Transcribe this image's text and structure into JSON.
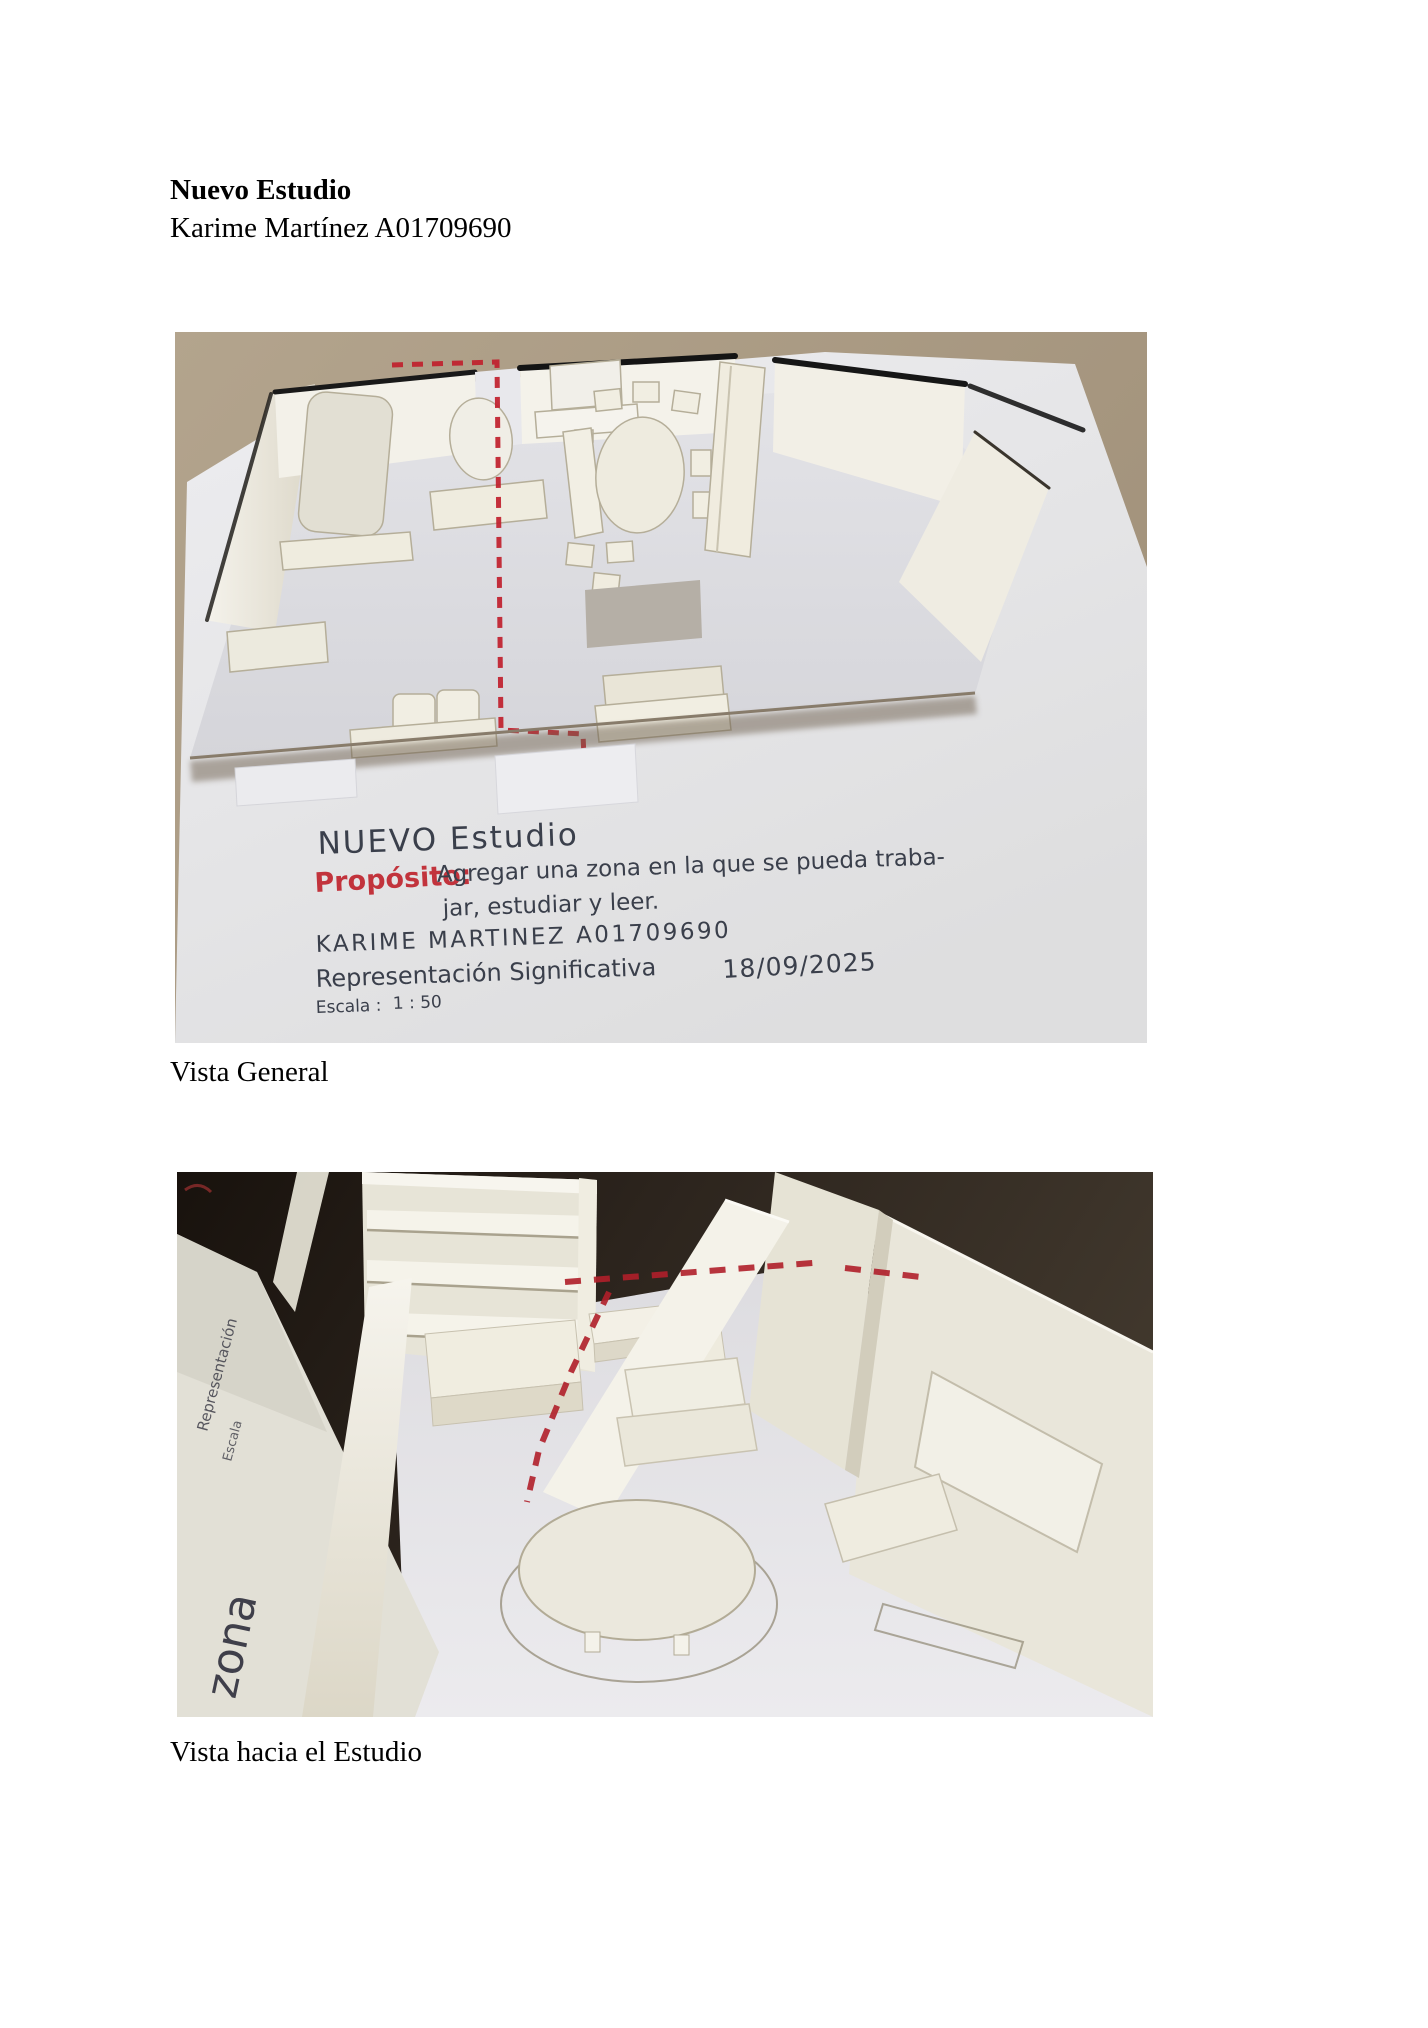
{
  "document": {
    "title": "Nuevo Estudio",
    "author": "Karime Martínez A01709690",
    "caption_photo1": "Vista General",
    "caption_photo2": "Vista hacia el Estudio"
  },
  "photo1": {
    "handwriting": {
      "title": "NUEVO Estudio",
      "purpose_label": "Propósito:",
      "purpose_line1": "Agregar una zona en la que se pueda traba-",
      "purpose_line2": "jar, estudiar y leer.",
      "author": "KARIME MARTINEZ  A01709690",
      "representation": "Representación Significativa",
      "date": "18/09/2025",
      "scale_label": "Escala :",
      "scale_value": "1 : 50"
    },
    "colors": {
      "table_surface": "#a99a83",
      "paper": "#e9e9ec",
      "cardboard": "#f1eee2",
      "marker_edge": "#1c1c1c",
      "zone_dashes": "#c0202c",
      "ink": "#3a3f4b",
      "ink_red": "#c2333c"
    }
  },
  "photo2": {
    "side_text": {
      "big": "zona",
      "small_lines": [
        "Representación",
        "Escala"
      ]
    },
    "colors": {
      "background_dark": "#241d16",
      "cardboard": "#efecdf",
      "floor": "#e7e6e9",
      "zone_dashes": "#b01f2a"
    }
  }
}
